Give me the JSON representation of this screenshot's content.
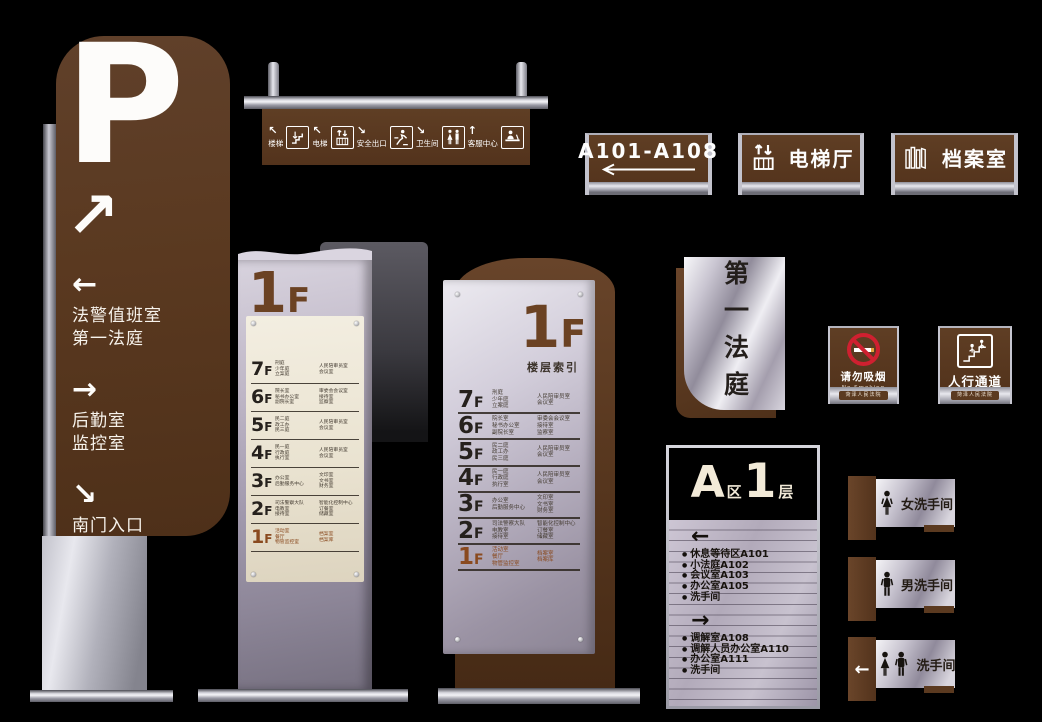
{
  "colors": {
    "brown": "#5b3a20",
    "red": "#cf2030",
    "silver": "#c7c3cf",
    "beige": "#ece4d2",
    "highlight": "#8a4a1f"
  },
  "parking_totem": {
    "letter": "P",
    "main_arrow": "↗",
    "directions": [
      {
        "arrow": "←",
        "lines": [
          "法警值班室",
          "第一法庭"
        ]
      },
      {
        "arrow": "→",
        "lines": [
          "后勤室",
          "监控室"
        ]
      },
      {
        "arrow": "↘",
        "lines": [
          "南门入口"
        ]
      }
    ]
  },
  "hanging_sign": {
    "items": [
      {
        "arrow": "↖",
        "label": "楼梯",
        "icon": "stairs"
      },
      {
        "arrow": "↖",
        "label": "电梯",
        "icon": "elevator"
      },
      {
        "arrow": "↘",
        "label": "安全出口",
        "icon": "emergency-exit"
      },
      {
        "arrow": "↘",
        "label": "卫生间",
        "icon": "toilet"
      },
      {
        "arrow": "↑",
        "label": "客服中心",
        "icon": "service-desk"
      }
    ]
  },
  "plate_signs": [
    {
      "label": "A101-A108",
      "arrow": "←"
    },
    {
      "label": "电梯厅",
      "icon": "elevator"
    },
    {
      "label": "档案室",
      "icon": "archive"
    }
  ],
  "floor_directory": {
    "small_header": "1F",
    "large_header": "1F",
    "large_subtitle": "楼层索引",
    "rows": [
      {
        "floor": "7F",
        "left": [
          "刑庭",
          "少年庭",
          "立案庭"
        ],
        "right": [
          "人民陪审员室",
          "会议室"
        ]
      },
      {
        "floor": "6F",
        "left": [
          "院长室",
          "秘书办公室",
          "副院长室"
        ],
        "right": [
          "审委会会议室",
          "接待室",
          "监察室"
        ]
      },
      {
        "floor": "5F",
        "left": [
          "民二庭",
          "政工办",
          "民三庭"
        ],
        "right": [
          "人民陪审员室",
          "会议室"
        ]
      },
      {
        "floor": "4F",
        "left": [
          "民一庭",
          "行政庭",
          "执行室"
        ],
        "right": [
          "人民陪审员室",
          "会议室"
        ]
      },
      {
        "floor": "3F",
        "left": [
          "办公室",
          "后勤服务中心"
        ],
        "right": [
          "文印室",
          "文书室",
          "财务室"
        ]
      },
      {
        "floor": "2F",
        "left": [
          "司法警察大队",
          "电教室",
          "接待室"
        ],
        "right": [
          "智能化控制中心",
          "订餐室",
          "储藏室"
        ]
      },
      {
        "floor": "1F",
        "left": [
          "活动室",
          "餐厅",
          "物管监控室"
        ],
        "right": [
          "档案室",
          "档案库"
        ],
        "highlight": true
      }
    ]
  },
  "courtroom_sign": {
    "text": "第一法庭"
  },
  "no_smoking_sign": {
    "title": "请勿吸烟",
    "subtitle": "No Smoking",
    "footer": "菏泽人民法院"
  },
  "walkway_sign": {
    "title": "人行通道",
    "footer": "菏泽人民法院",
    "icon": "stairs-people"
  },
  "zone_directory": {
    "zone_letter": "A",
    "zone_suffix": "区",
    "floor_number": "1",
    "floor_suffix": "层",
    "first_arrow": "←",
    "first_items": [
      "休息等待区A101",
      "小法庭A102",
      "会议室A103",
      "办公室A105",
      "洗手间"
    ],
    "second_arrow": "→",
    "second_items": [
      "调解室A108",
      "调解人员办公室A110",
      "办公室A111",
      "洗手间"
    ]
  },
  "restroom_signs": [
    {
      "label": "女洗手间",
      "icon": "woman"
    },
    {
      "label": "男洗手间",
      "icon": "man"
    },
    {
      "label": "洗手间",
      "icon": "woman-man",
      "arrow": "←"
    }
  ]
}
